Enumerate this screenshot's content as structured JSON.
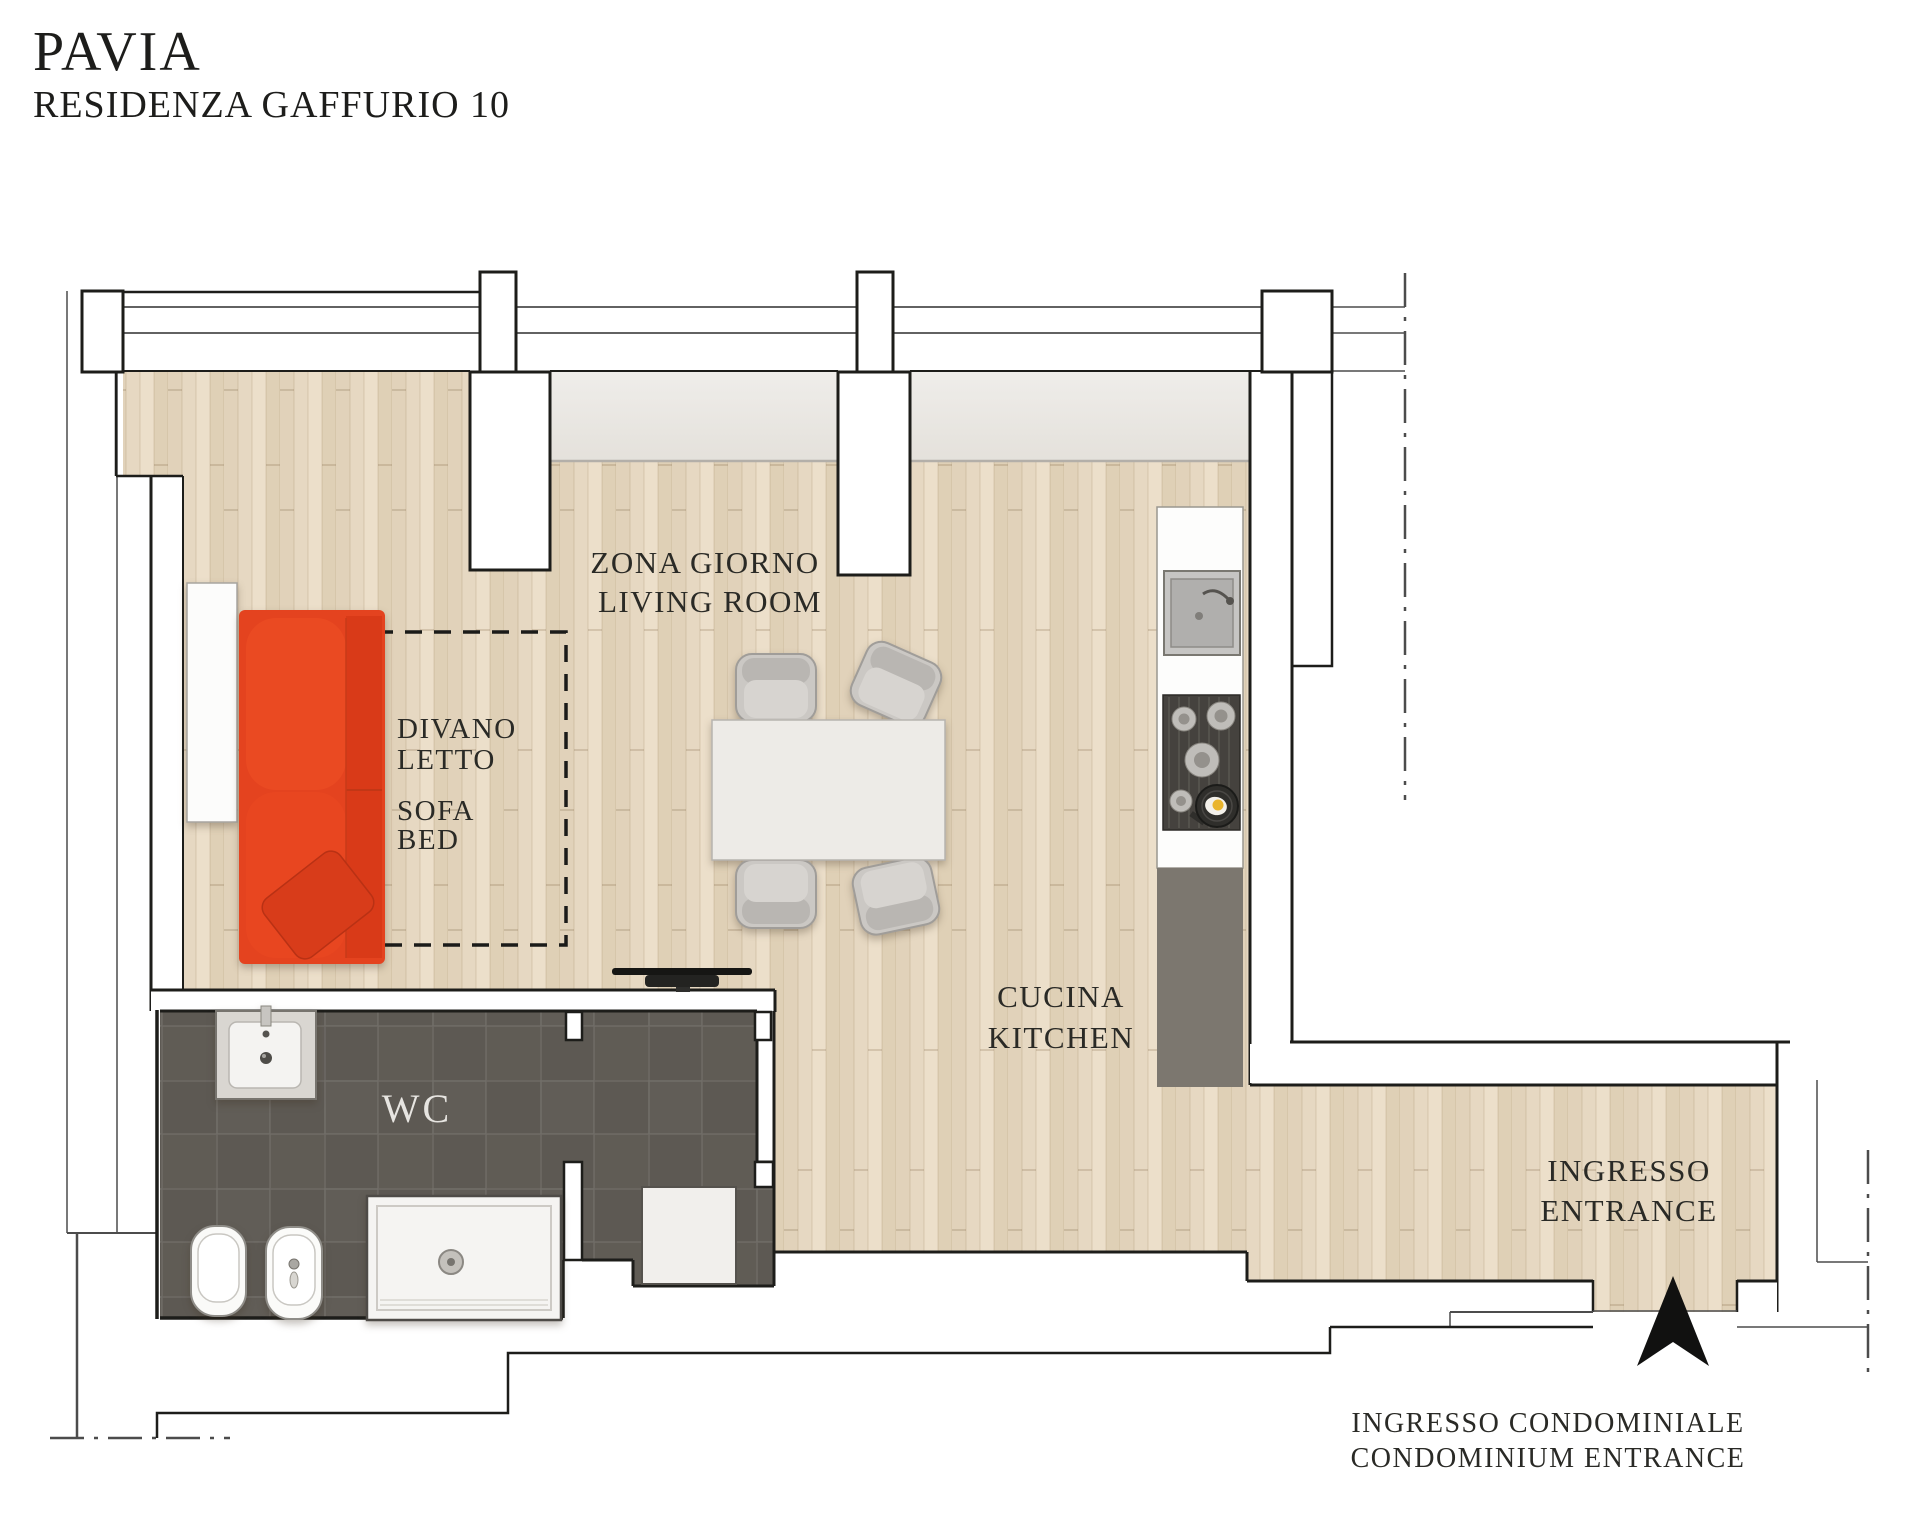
{
  "title": {
    "project": "PAVIA",
    "residence": "RESIDENZA GAFFURIO 10"
  },
  "plan": {
    "living_room": {
      "label_it": "ZONA GIORNO",
      "label_en": "LIVING ROOM"
    },
    "sofa_bed": {
      "word1": "DIVANO",
      "word2": "LETTO",
      "word3": "SOFA",
      "word4": "BED"
    },
    "kitchen": {
      "label_it": "CUCINA",
      "label_en": "KITCHEN"
    },
    "bathroom": {
      "label": "WC"
    },
    "entrance": {
      "label_it": "INGRESSO",
      "label_en": "ENTRANCE"
    },
    "condo_entrance": {
      "label_it": "INGRESSO CONDOMINIALE",
      "label_en": "CONDOMINIUM ENTRANCE"
    }
  },
  "furniture": {
    "sofa": "sofa-bed",
    "pillow": "throw-pillow",
    "wardrobe": "wardrobe",
    "tv": "tv",
    "table": "dining-table",
    "chairs": 4,
    "kitchen_units": [
      "sink",
      "gas-hob",
      "counter"
    ],
    "bathroom_fixtures": [
      "washbasin",
      "toilet",
      "bidet",
      "shower"
    ],
    "cabinet": "storage-cabinet",
    "arrow": "entrance-arrow"
  },
  "colors": {
    "sofa": "#e4431f",
    "wood_floor": "#e6d8c2",
    "bathroom_tile": "#5d5953",
    "counter_dark": "#7c776f",
    "window_sill": "#eae7e2",
    "wall_line": "#1d1d1a"
  }
}
